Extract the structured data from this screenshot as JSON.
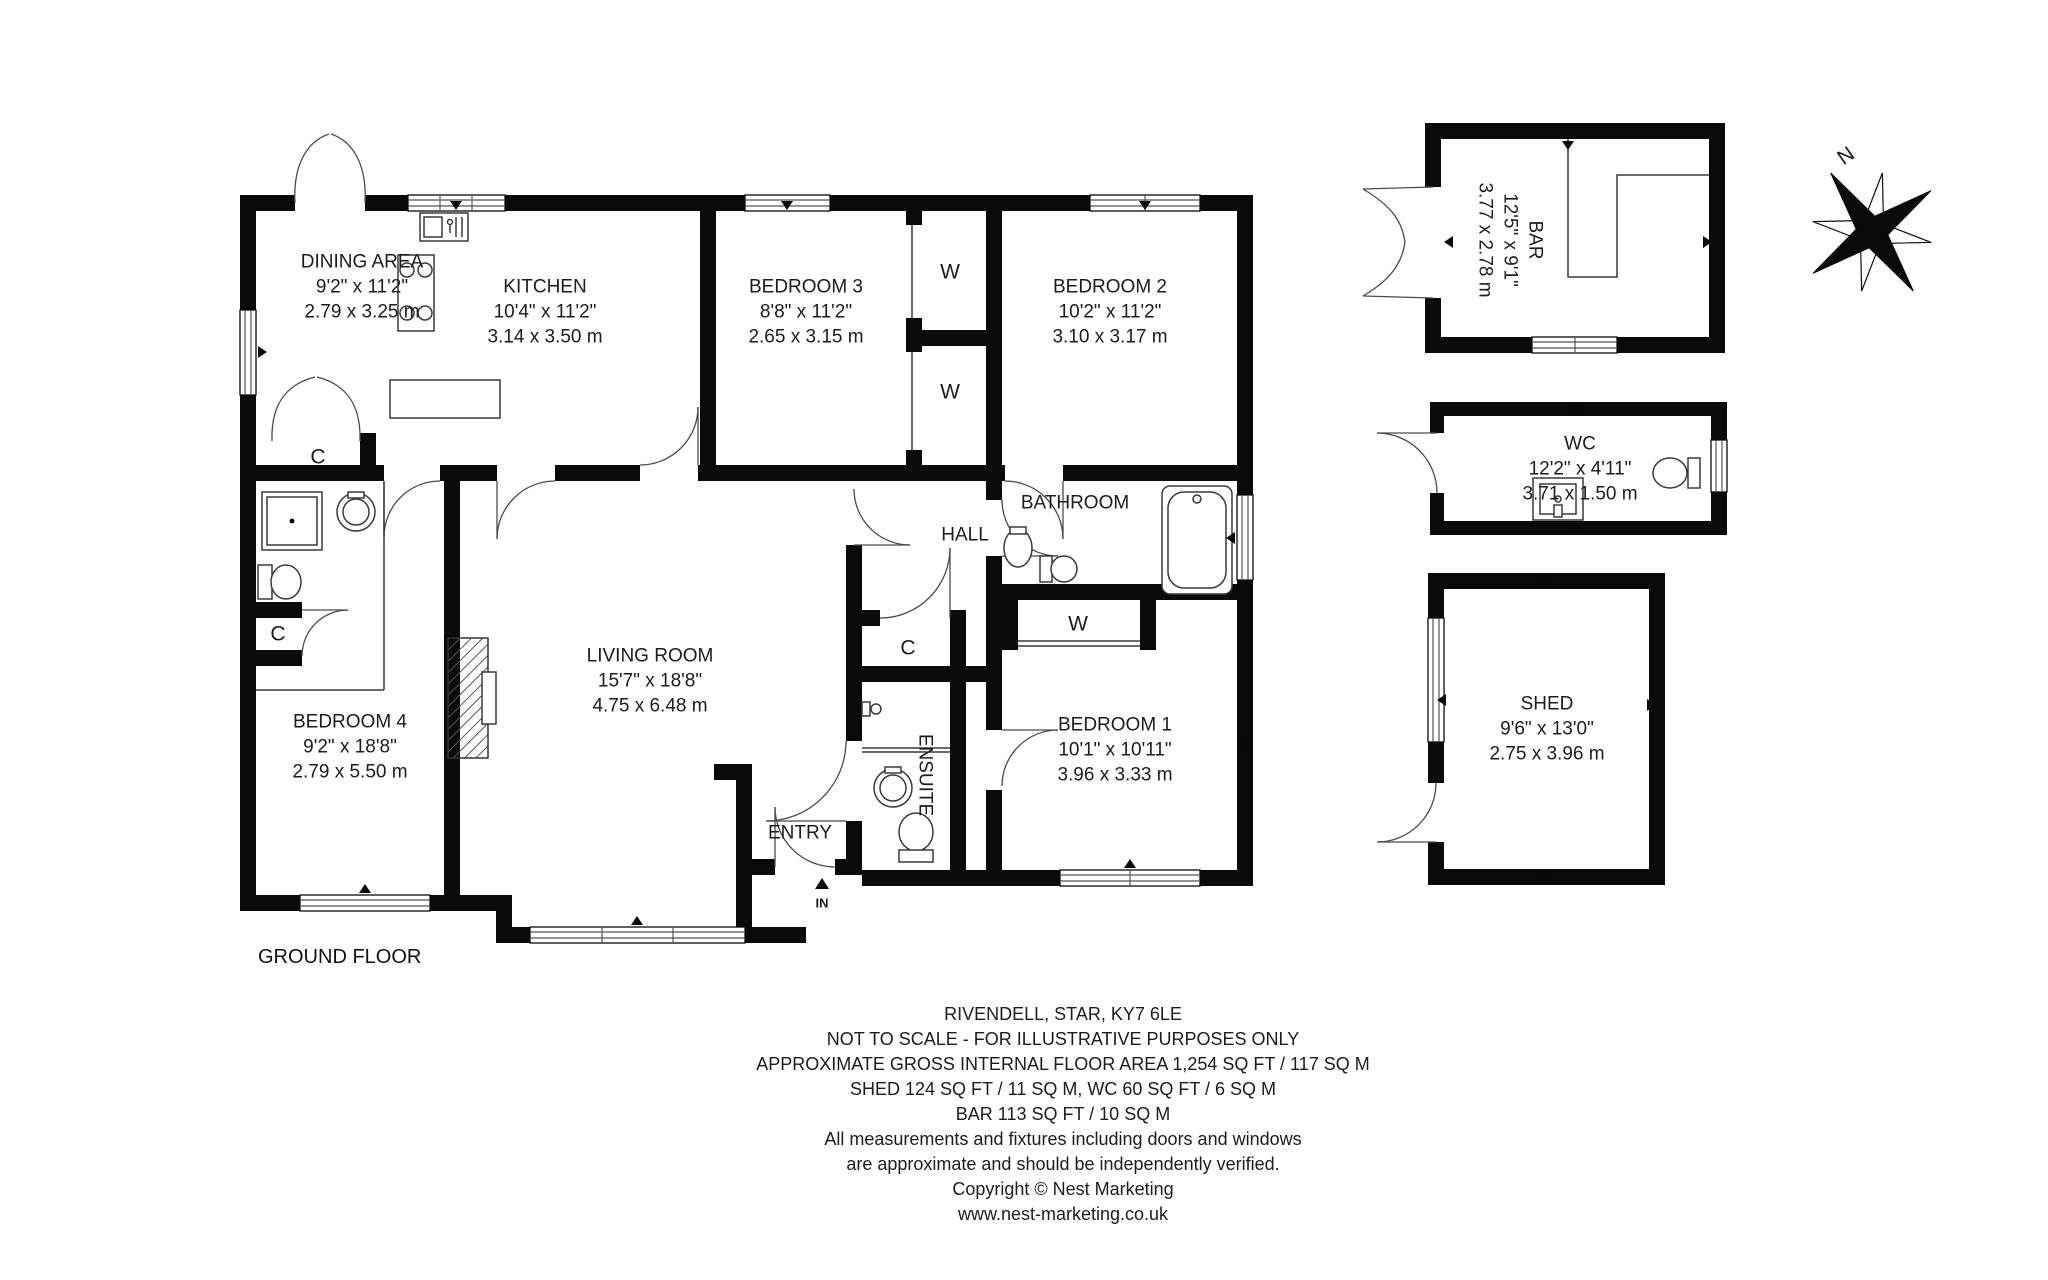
{
  "floor_label": "GROUND FLOOR",
  "rooms": {
    "dining": {
      "name": "DINING AREA",
      "imperial": "9'2\" x 11'2\"",
      "metric": "2.79 x 3.25 m"
    },
    "kitchen": {
      "name": "KITCHEN",
      "imperial": "10'4\" x 11'2\"",
      "metric": "3.14 x 3.50 m"
    },
    "bedroom3": {
      "name": "BEDROOM 3",
      "imperial": "8'8\" x 11'2\"",
      "metric": "2.65 x 3.15 m"
    },
    "bedroom2": {
      "name": "BEDROOM 2",
      "imperial": "10'2\" x 11'2\"",
      "metric": "3.10 x 3.17 m"
    },
    "living": {
      "name": "LIVING ROOM",
      "imperial": "15'7\" x 18'8\"",
      "metric": "4.75 x 6.48 m"
    },
    "bedroom4": {
      "name": "BEDROOM 4",
      "imperial": "9'2\" x 18'8\"",
      "metric": "2.79 x 5.50 m"
    },
    "bedroom1": {
      "name": "BEDROOM 1",
      "imperial": "10'1\" x 10'11\"",
      "metric": "3.96 x 3.33 m"
    },
    "bar": {
      "name": "BAR",
      "imperial": "12'5\" x 9'1\"",
      "metric": "3.77 x 2.78 m"
    },
    "wc": {
      "name": "WC",
      "imperial": "12'2\" x 4'11\"",
      "metric": "3.71 x 1.50 m"
    },
    "shed": {
      "name": "SHED",
      "imperial": "9'6\" x 13'0\"",
      "metric": "2.75 x 3.96 m"
    }
  },
  "areas": {
    "hall": "HALL",
    "bathroom": "BATHROOM",
    "ensuite": "ENSUITE",
    "entry": "ENTRY"
  },
  "markers": {
    "closet": "C",
    "wardrobe": "W",
    "entrance": "IN",
    "north": "N"
  },
  "footer": {
    "lines": [
      "RIVENDELL, STAR, KY7 6LE",
      "NOT TO SCALE - FOR ILLUSTRATIVE PURPOSES ONLY",
      "APPROXIMATE GROSS INTERNAL FLOOR AREA 1,254 SQ FT / 117 SQ M",
      "SHED 124 SQ FT / 11 SQ M, WC 60 SQ FT / 6 SQ M",
      "BAR 113 SQ FT / 10 SQ M",
      "All measurements and fixtures including doors and windows",
      "are approximate and should be independently verified.",
      "Copyright © Nest Marketing",
      "www.nest-marketing.co.uk"
    ]
  },
  "colors": {
    "walls": "#0a0a0a",
    "text": "#1c1c1c",
    "background": "#ffffff"
  }
}
